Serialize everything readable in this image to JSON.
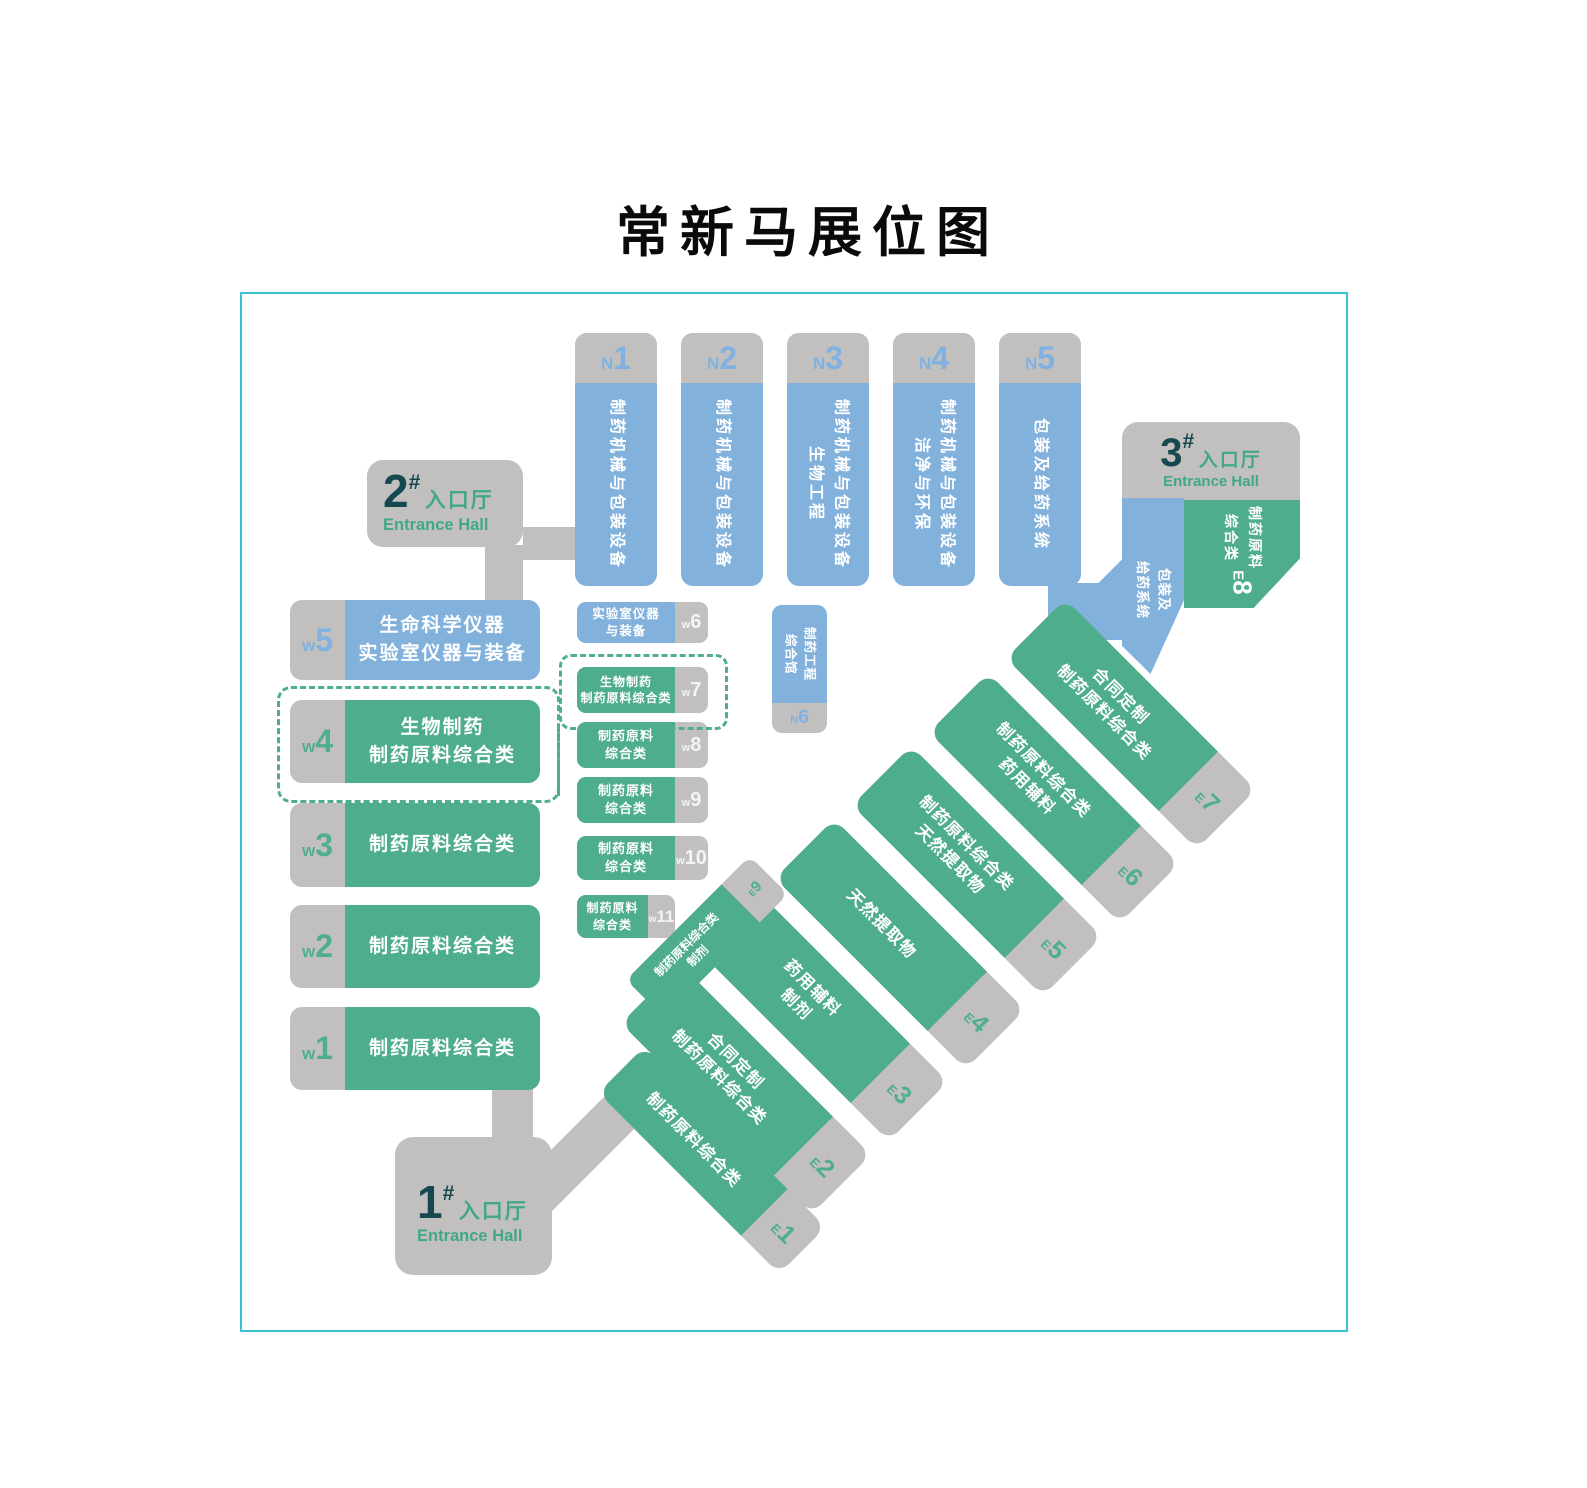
{
  "title": "常新马展位图",
  "colors": {
    "blue": "#82B1DC",
    "green": "#4EAD8A",
    "gray": "#C1C0BE",
    "dark_teal": "#15494F",
    "entrance_green": "#41A78B",
    "map_border": "#3ABFD3",
    "label_blue": "#7FB2E0",
    "label_green": "#4FAE8B",
    "text_white": "#FFFFFF"
  },
  "entrances": [
    {
      "num": "1",
      "hash": "#",
      "cn": "入口厅",
      "en": "Entrance Hall"
    },
    {
      "num": "2",
      "hash": "#",
      "cn": "入口厅",
      "en": "Entrance Hall"
    },
    {
      "num": "3",
      "hash": "#",
      "cn": "入口厅",
      "en": "Entrance Hall"
    }
  ],
  "halls_n": [
    {
      "prefix": "N",
      "num": "1",
      "lines": [
        "制药机械与包装设备"
      ]
    },
    {
      "prefix": "N",
      "num": "2",
      "lines": [
        "制药机械与包装设备"
      ]
    },
    {
      "prefix": "N",
      "num": "3",
      "lines": [
        "制药机械与包装设备",
        "生物工程"
      ]
    },
    {
      "prefix": "N",
      "num": "4",
      "lines": [
        "制药机械与包装设备",
        "洁净与环保"
      ]
    },
    {
      "prefix": "N",
      "num": "5",
      "lines": [
        "包装及给药系统"
      ]
    },
    {
      "prefix": "N",
      "num": "6",
      "lines": [
        "制药工程",
        "综合馆"
      ]
    }
  ],
  "halls_w": [
    {
      "prefix": "w",
      "num": "1",
      "lines": [
        "制药原料综合类"
      ]
    },
    {
      "prefix": "w",
      "num": "2",
      "lines": [
        "制药原料综合类"
      ]
    },
    {
      "prefix": "w",
      "num": "3",
      "lines": [
        "制药原料综合类"
      ]
    },
    {
      "prefix": "w",
      "num": "4",
      "lines": [
        "生物制药",
        "制药原料综合类"
      ]
    },
    {
      "prefix": "w",
      "num": "5",
      "lines": [
        "生命科学仪器",
        "实验室仪器与装备"
      ]
    },
    {
      "prefix": "w",
      "num": "6",
      "lines": [
        "实验室仪器",
        "与装备"
      ]
    },
    {
      "prefix": "w",
      "num": "7",
      "lines": [
        "生物制药",
        "制药原料综合类"
      ]
    },
    {
      "prefix": "w",
      "num": "8",
      "lines": [
        "制药原料",
        "综合类"
      ]
    },
    {
      "prefix": "w",
      "num": "9",
      "lines": [
        "制药原料",
        "综合类"
      ]
    },
    {
      "prefix": "w",
      "num": "10",
      "lines": [
        "制药原料",
        "综合类"
      ]
    },
    {
      "prefix": "w",
      "num": "11",
      "lines": [
        "制药原料",
        "综合类"
      ]
    }
  ],
  "halls_e": [
    {
      "prefix": "E",
      "num": "1",
      "lines": [
        "制药原料综合类"
      ]
    },
    {
      "prefix": "E",
      "num": "2",
      "lines": [
        "合同定制",
        "制药原料综合类"
      ]
    },
    {
      "prefix": "E",
      "num": "3",
      "lines": [
        "药用辅料",
        "制剂"
      ]
    },
    {
      "prefix": "E",
      "num": "4",
      "lines": [
        "天然提取物"
      ]
    },
    {
      "prefix": "E",
      "num": "5",
      "lines": [
        "制药原料综合类",
        "天然提取物"
      ]
    },
    {
      "prefix": "E",
      "num": "6",
      "lines": [
        "制药原料综合类",
        "药用辅料"
      ]
    },
    {
      "prefix": "E",
      "num": "7",
      "lines": [
        "合同定制",
        "制药原料综合类"
      ]
    },
    {
      "prefix": "E",
      "num": "8",
      "lines": [
        "制药原料",
        "综合类"
      ]
    },
    {
      "prefix": "E",
      "num": "9",
      "lines": [
        "制药原料综合类",
        "制剂"
      ]
    }
  ],
  "e8_blue": {
    "lines": [
      "包装及",
      "给药系统"
    ]
  }
}
